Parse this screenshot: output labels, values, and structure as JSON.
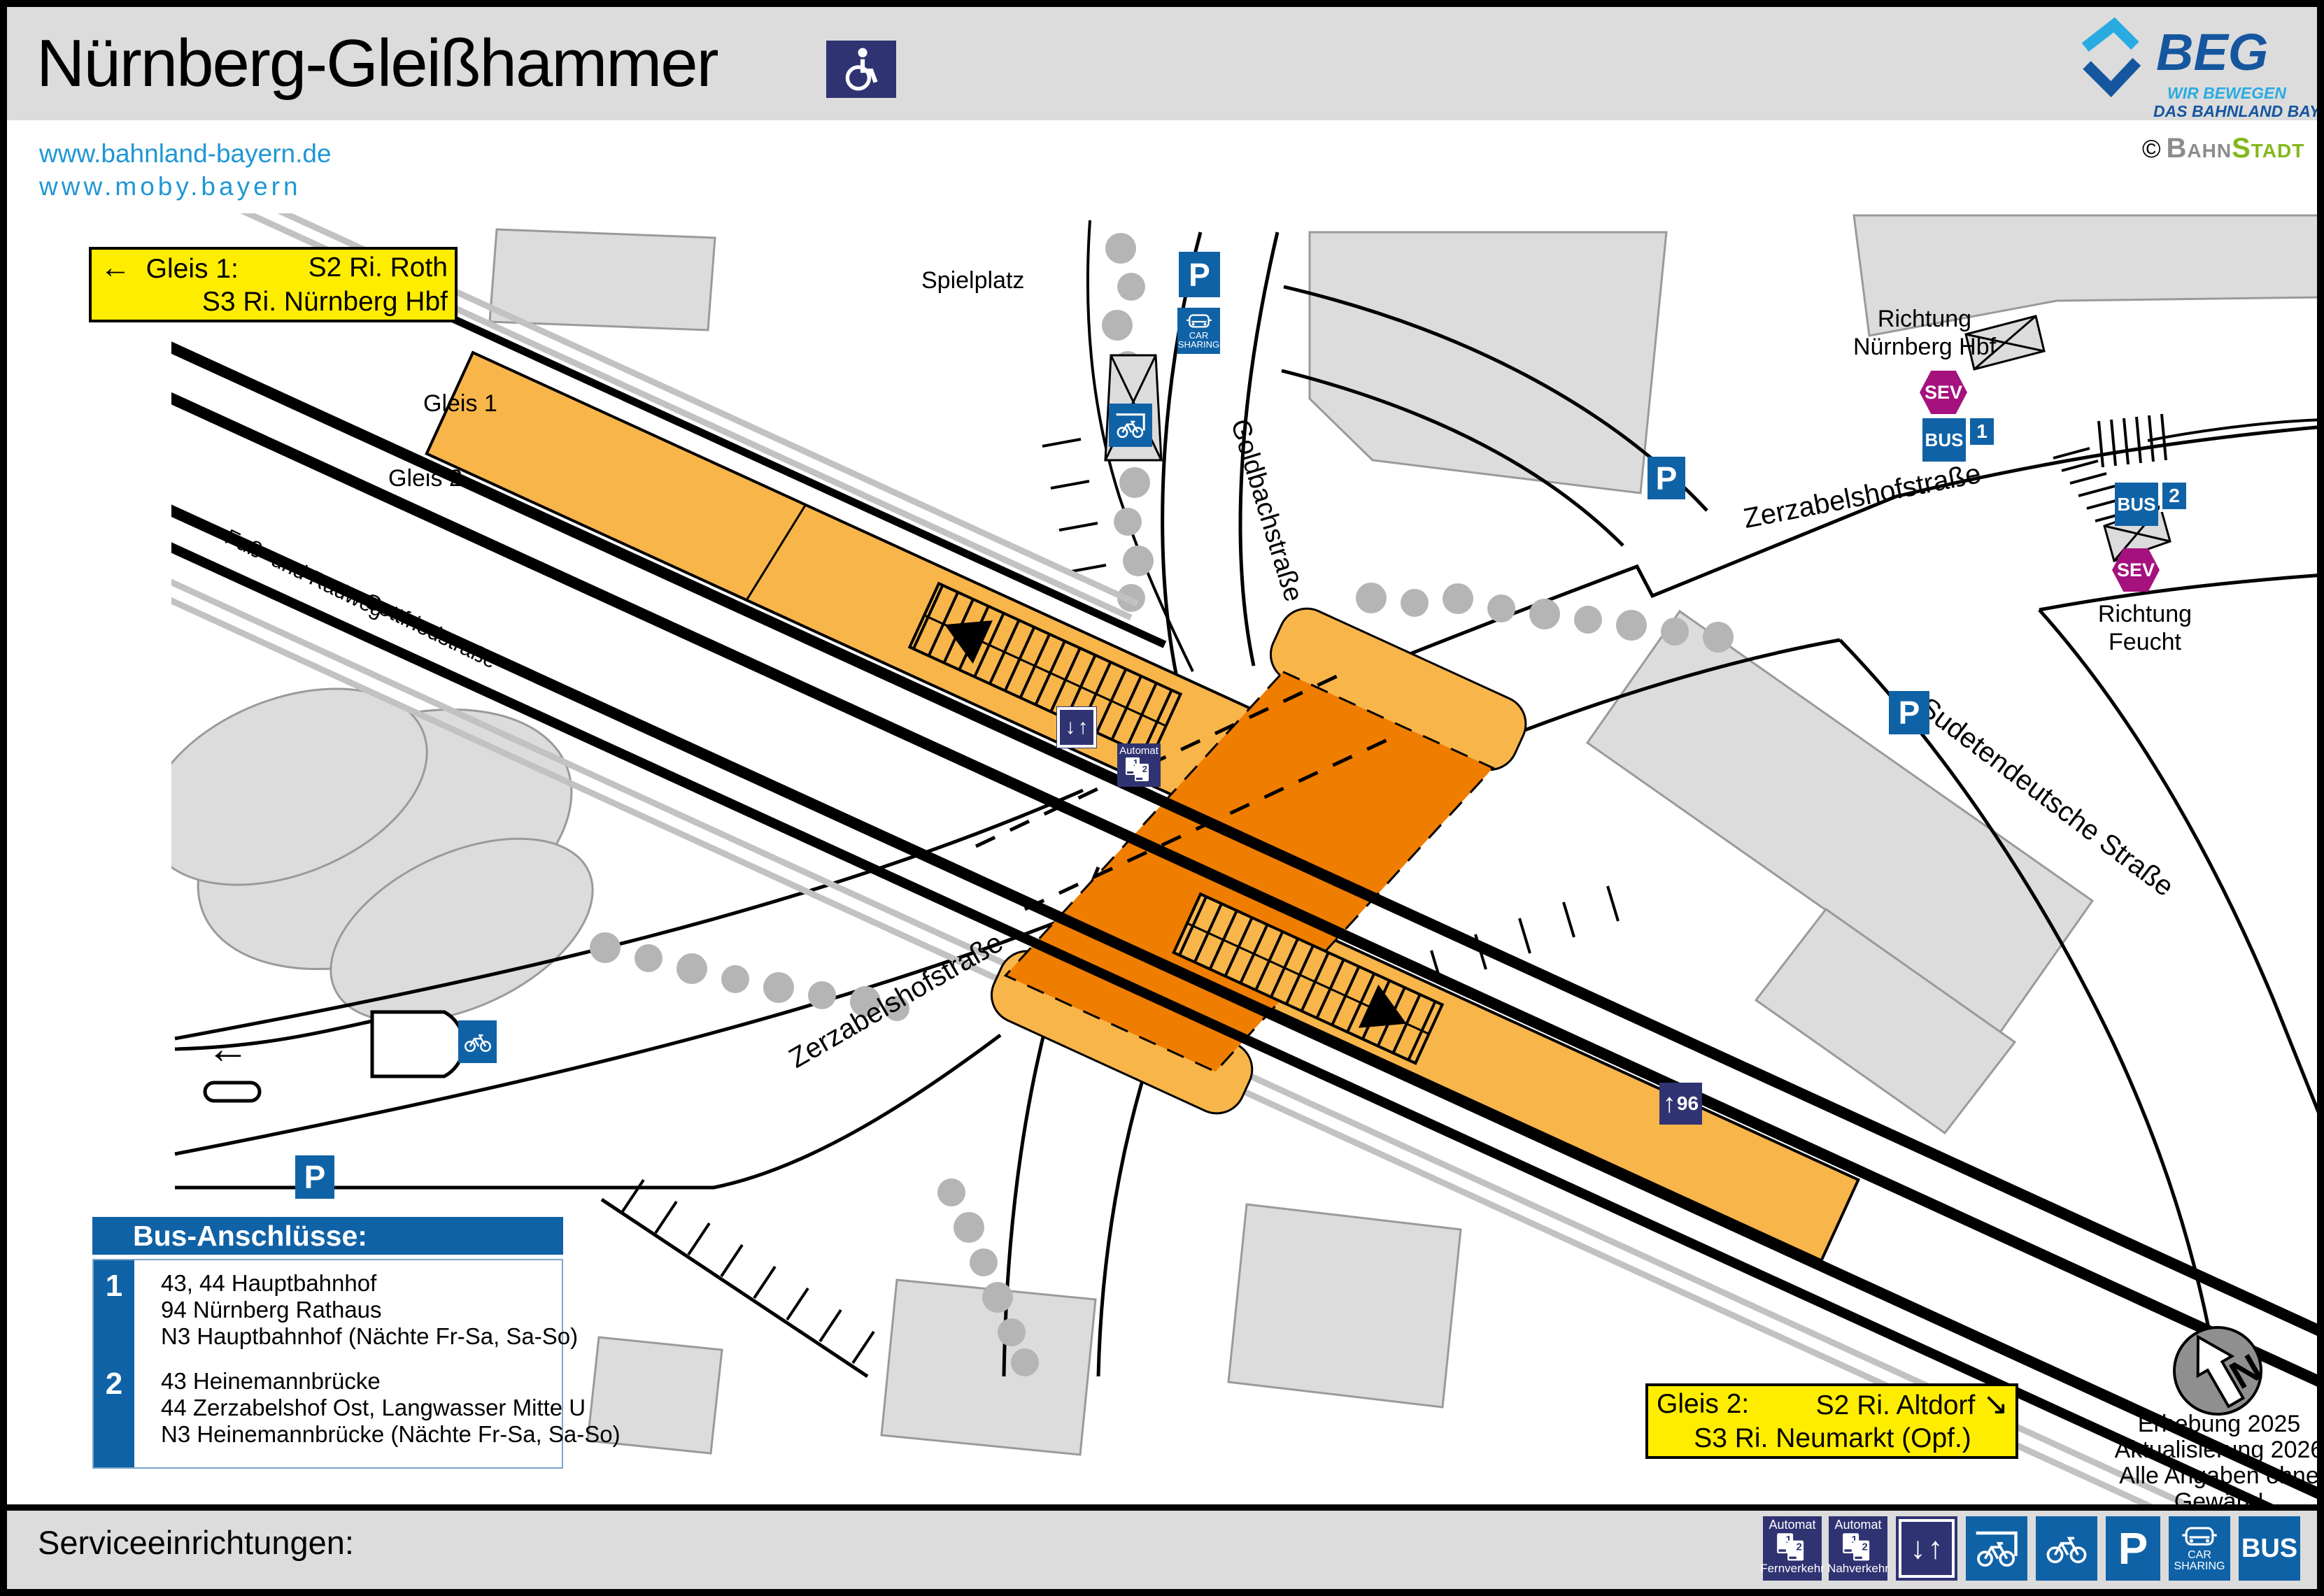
{
  "header": {
    "title": "Nürnberg-Gleißhammer",
    "links": [
      "www.bahnland-bayern.de",
      "www.moby.bayern"
    ],
    "beg": {
      "name": "BEG",
      "tagline1": "WIR BEWEGEN",
      "tagline2": "DAS BAHNLAND BAYERN"
    },
    "credit": {
      "symbol": "©",
      "part1": "Bahn",
      "part2": "Stadt"
    }
  },
  "track_boxes": {
    "gleis1": {
      "arrow": "←",
      "label": "Gleis 1:",
      "dest1": "S2 Ri. Roth",
      "dest2": "S3 Ri. Nürnberg Hbf"
    },
    "gleis2": {
      "label": "Gleis 2:",
      "dest1": "S2 Ri. Altdorf",
      "arrow": "↘",
      "dest2": "S3 Ri. Neumarkt (Opf.)"
    }
  },
  "map_labels": {
    "spielplatz": "Spielplatz",
    "gleis1": "Gleis 1",
    "gleis2": "Gleis 2",
    "goldbachstrasse": "Goldbachstraße",
    "zerzabelshofstrasse_east": "Zerzabelshofstraße",
    "zerzabelshofstrasse_west": "Zerzabelshofstraße",
    "sudetendeutsche": "Sudetendeutsche Straße",
    "fussweg": "Fuß- und Radweg",
    "gottfriedstrasse": "Gottfriedstraße",
    "richtung_hbf_1": "Richtung",
    "richtung_hbf_2": "Nürnberg Hbf",
    "richtung_feucht_1": "Richtung",
    "richtung_feucht_2": "Feucht"
  },
  "icons": {
    "p": "P",
    "bus": "BUS",
    "sev": "SEV",
    "car_line1": "CAR",
    "car_line2": "SHARING",
    "automat": "Automat",
    "machine1": "1",
    "machine2": "2",
    "platform_length": "96",
    "stop1": "1",
    "stop2": "2",
    "arrow_left": "←",
    "arrow_up": "↑",
    "arrow_down": "↓"
  },
  "bus_box": {
    "title": "Bus-Anschlüsse:",
    "entries": [
      {
        "num": "1",
        "lines": [
          "43, 44 Hauptbahnhof",
          "94 Nürnberg Rathaus",
          "N3 Hauptbahnhof (Nächte Fr-Sa, Sa-So)"
        ]
      },
      {
        "num": "2",
        "lines": [
          "43 Heinemannbrücke",
          "44 Zerzabelshof Ost, Langwasser Mitte U",
          "N3 Heinemannbrücke (Nächte Fr-Sa, Sa-So)"
        ]
      }
    ]
  },
  "note": {
    "compass": "N",
    "line1": "Erhebung 2025",
    "line2": "Aktualisierung 2026",
    "line3": "Alle Angaben ohne Gewähr!"
  },
  "services": {
    "label": "Serviceeinrichtungen:",
    "automat_fern": {
      "top": "Automat",
      "bottom": "Fernverkehr"
    },
    "automat_nah": {
      "top": "Automat",
      "bottom": "Nahverkehr"
    }
  },
  "colors": {
    "accent_blue": "#1062a6",
    "navy": "#303372",
    "sev_magenta": "#a5117d",
    "box_yellow": "#ffed00",
    "platform_orange": "#f8b54a",
    "underpass_orange": "#ef7d00",
    "link_blue": "#1f97d4",
    "beg_dark": "#15569f",
    "beg_light": "#29abe2",
    "bahn_gray": "#8c8c8c",
    "stadt_green": "#83b81a"
  }
}
